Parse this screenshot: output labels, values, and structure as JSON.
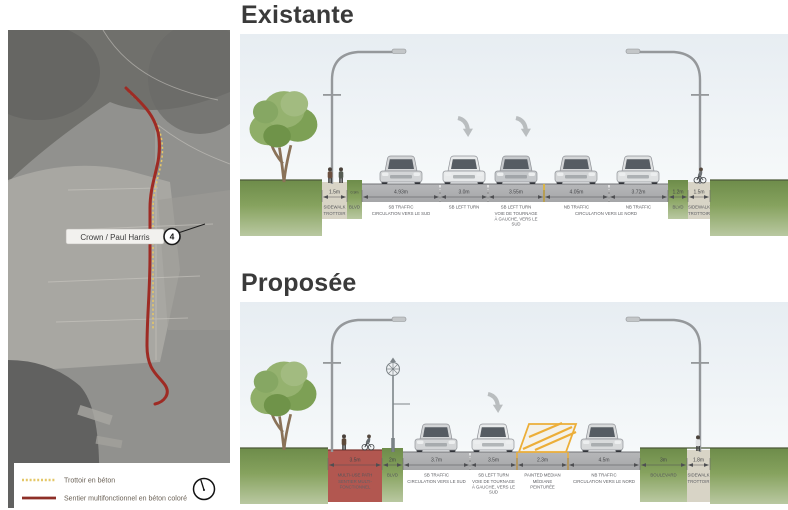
{
  "map": {
    "callout": {
      "label": "Crown / Paul Harris",
      "number": "4"
    },
    "legend": {
      "items": [
        {
          "label": "Trottoir en béton"
        },
        {
          "label": "Sentier multifonctionnel en béton coloré"
        }
      ]
    }
  },
  "sections": {
    "existante": {
      "title": "Existante",
      "segments": [
        {
          "value": "1.5m",
          "en": "SIDEWALK",
          "fr": [
            "TROTTOIR"
          ]
        },
        {
          "value": "0.9m",
          "en": "BLVD",
          "fr": []
        },
        {
          "value": "4.93m",
          "en": "SB TRAFFIC",
          "fr": [
            "CIRCULATION VERS LE SUD"
          ]
        },
        {
          "value": "3.0m",
          "en": "SB LEFT TURN",
          "fr": []
        },
        {
          "value": "3.55m",
          "en": "SB LEFT TURN",
          "fr": [
            "VOIE DE TOURNAGE",
            "À GAUCHE, VERS LE",
            "SUD"
          ]
        },
        {
          "value": "4.05m",
          "en": "NB TRAFFIC",
          "fr": []
        },
        {
          "value": "3.72m",
          "en": "NB TRAFFIC",
          "fr": [
            "CIRCULATION VERS LE NORD"
          ]
        },
        {
          "value": "1.2m",
          "en": "BLVD",
          "fr": []
        },
        {
          "value": "1.5m",
          "en": "SIDEWALK",
          "fr": [
            "TROTTOIR"
          ]
        }
      ]
    },
    "proposee": {
      "title": "Proposée",
      "segments": [
        {
          "value": "3.5m",
          "en": "MULTI-USE PATH",
          "fr": [
            "SENTIER MULTI-",
            "FONCTIONNEL"
          ]
        },
        {
          "value": "2m",
          "en": "BLVD",
          "fr": []
        },
        {
          "value": "3.7m",
          "en": "SB TRAFFIC",
          "fr": [
            "CIRCULATION VERS LE SUD"
          ]
        },
        {
          "value": "3.5m",
          "en": "SB LEFT TURN",
          "fr": [
            "VOIE DE TOURNAGE",
            "À GAUCHE, VERS LE",
            "SUD"
          ]
        },
        {
          "value": "2.3m",
          "en": "PAINTED MEDIAN",
          "fr": [
            "MÉDIANE",
            "PEINTURÉE"
          ]
        },
        {
          "value": "4.5m",
          "en": "NB TRAFFIC",
          "fr": [
            "CIRCULATION VERS LE NORD"
          ]
        },
        {
          "value": "3m",
          "en": "BOULEVARD",
          "fr": []
        },
        {
          "value": "1.8m",
          "en": "SIDEWALK",
          "fr": [
            "TROTTOIR"
          ]
        }
      ]
    }
  },
  "colors": {
    "route_sentier": "#9e2b24",
    "route_trottoir": "#e8c766",
    "multi_use_path": "#b25750",
    "painted_median": "#ecae38",
    "road": "#aeafb1",
    "grass": "#86a25e",
    "heading_text": "#3a3a3a"
  }
}
